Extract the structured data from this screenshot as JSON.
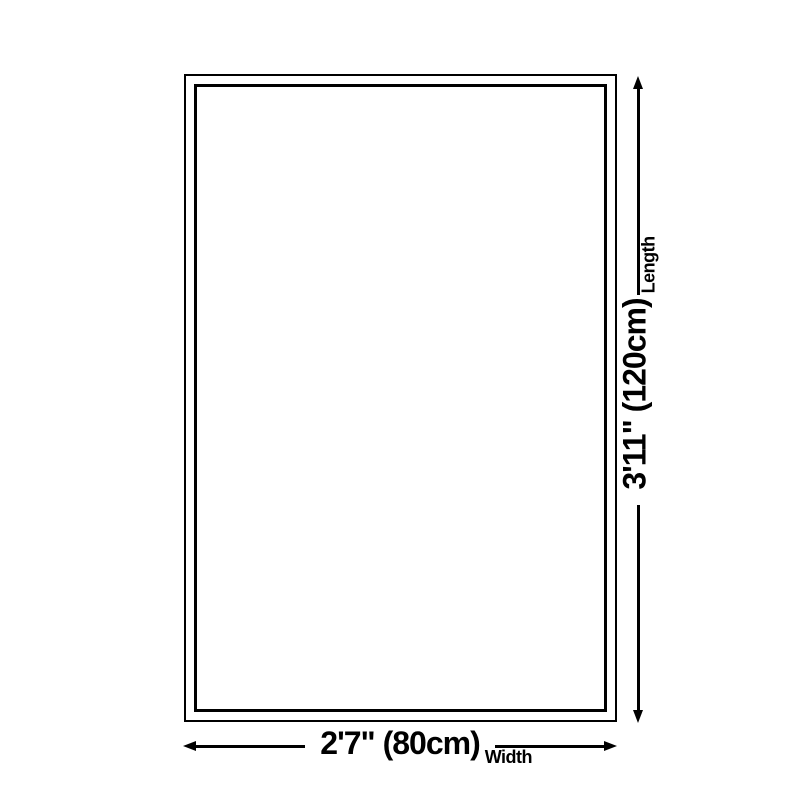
{
  "diagram": {
    "type": "product-size-diagram",
    "shape": "rectangle",
    "background_color": "#ffffff",
    "line_color": "#000000",
    "length": {
      "value": "3'11\" (120cm)",
      "label": "Length"
    },
    "width": {
      "value": "2'7\" (80cm)",
      "label": "Width"
    }
  }
}
